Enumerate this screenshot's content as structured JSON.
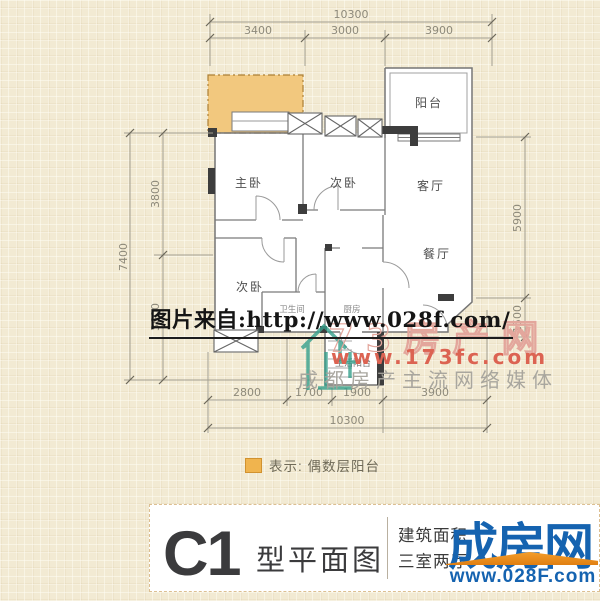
{
  "floorplan": {
    "rooms": {
      "master_bedroom": "主卧",
      "bedroom2": "次卧",
      "living_room": "客厅",
      "balcony": "阳台",
      "bedroom3": "次卧",
      "dining_room": "餐厅",
      "bathroom": "卫生间",
      "kitchen": "厨房",
      "service_balcony": "生活阳台"
    },
    "dimensions": {
      "top_total": "10300",
      "top_segments": [
        "3400",
        "3000",
        "3900"
      ],
      "left_total": "7400",
      "left_segments": [
        "3800",
        "3600"
      ],
      "right_segments": [
        "5900",
        "1500"
      ],
      "bottom_segments": [
        "2800",
        "1700",
        "1900",
        "3900"
      ],
      "bottom_total": "10300"
    },
    "legend": {
      "swatch_color": "#f0b44e",
      "label": "表示: 偶数层阳台"
    },
    "even_floor_balcony_color": "#f2c87e"
  },
  "watermarks": {
    "source_url_line": "图片来自:http://www.028f.com/",
    "portal_name_outline": "73房产网",
    "portal_url": "www.173fc.com",
    "portal_slogan": "成都房产主流网络媒体",
    "portal_red": "#dc6352",
    "portal_teal": "#35a08c"
  },
  "title_block": {
    "plan_code": "C1",
    "plan_type_label": "型平面图",
    "info_line1": "建筑面积",
    "info_line2": "三室两厅",
    "brand_name": "成房网",
    "brand_url": "www.028F.com",
    "brand_blue": "#1563b0",
    "brand_orange": "#ef8f1f"
  }
}
